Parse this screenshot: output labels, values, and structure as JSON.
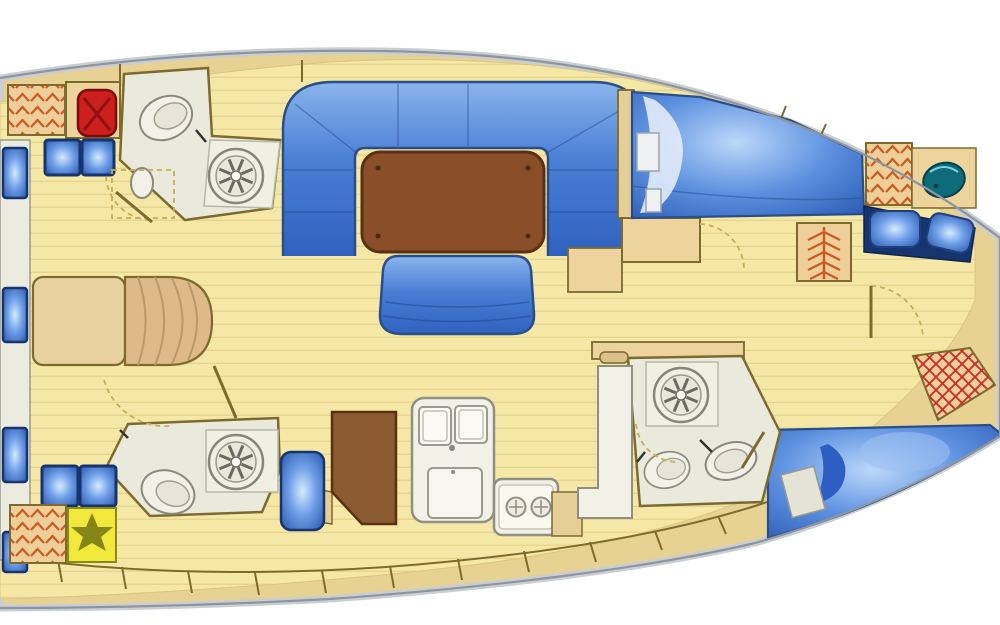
{
  "diagram": {
    "type": "sailboat-interior-floor-plan",
    "view": "overhead deck plan",
    "orientation": {
      "bow": "left",
      "stern": "right"
    },
    "rooms": [
      "forward cabin",
      "forward head upper",
      "forward head lower",
      "saloon",
      "galley",
      "navigation area",
      "aft corridor",
      "aft cabin upper",
      "aft cabin lower",
      "aft head"
    ],
    "fixtures": {
      "toilets": 3,
      "shower_drains": 3,
      "wash_basins": 3,
      "double_berths": 3,
      "settee": "U-shaped saloon settee",
      "saloon_tables": 1,
      "aft_bench_seats": 1,
      "galley_sinks": 2,
      "stove_burners": 2,
      "deck_hatches": 6,
      "hull_windows": 4,
      "hatched_lockers": 5,
      "windlass": 1,
      "liferaft_box": 1
    }
  },
  "palette": {
    "page_bg": "#ffffff",
    "hull_rim_light": "#c9ced4",
    "hull_rim_dark": "#8e959c",
    "deck_tan": "#e7d193",
    "floor_yellow": "#f5e8a6",
    "floor_plank": "#e7d58e",
    "wall_line": "#7c6a2f",
    "furniture_tan": "#ecd49c",
    "berth_head_tan": "#ead2a0",
    "berth_foot_tan": "#ddba88",
    "blue_dark": "#16356e",
    "blue_mid": "#2a4e8a",
    "table_brown": "#8a4f28",
    "table_edge": "#5a3014",
    "cabinet_brown": "#8a5a30",
    "fixture_white": "#f2f1e8",
    "fixture_stroke": "#8f8f83",
    "head_floor": "#eaeadc",
    "stall_floor": "#f0f0e2",
    "locker_orange": "#cc5a22",
    "windlass_red": "#ce1f1f",
    "sink_teal": "#0d6b7a",
    "liferaft_yellow": "#f0e83a",
    "door_dash": "#c9ab58"
  }
}
